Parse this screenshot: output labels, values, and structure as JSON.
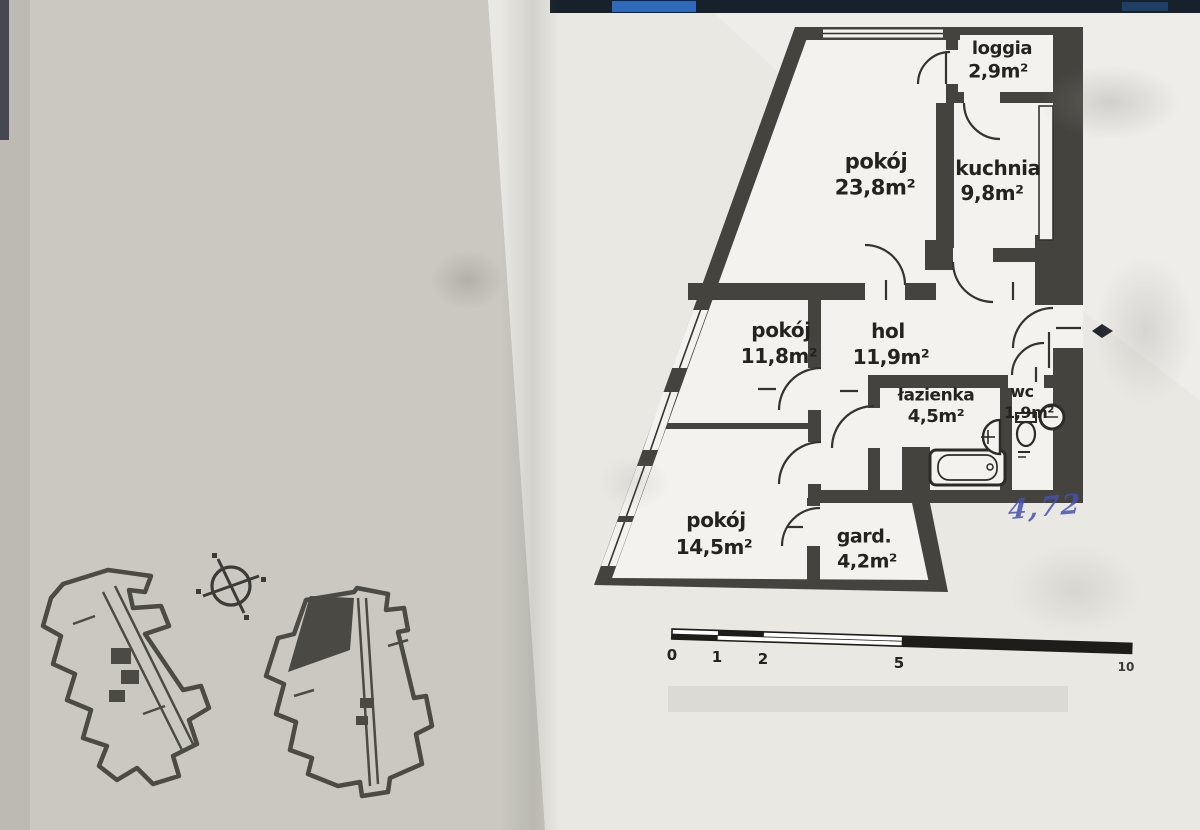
{
  "photo": {
    "handwritten_note": "4,72"
  },
  "floor_plan": {
    "rooms": [
      {
        "name": "loggia",
        "area": "2,9m²"
      },
      {
        "name": "pokój",
        "area": "23,8m²"
      },
      {
        "name": "kuchnia",
        "area": "9,8m²"
      },
      {
        "name": "pokój",
        "area": "11,8m²"
      },
      {
        "name": "hol",
        "area": "11,9m²"
      },
      {
        "name": "łazienka",
        "area": "4,5m²"
      },
      {
        "name": "wc",
        "area": "1,9m²"
      },
      {
        "name": "pokój",
        "area": "14,5m²"
      },
      {
        "name": "gard.",
        "area": "4,2m²"
      }
    ],
    "scale_bar": {
      "labels": [
        "0",
        "1",
        "2",
        "5",
        "10"
      ]
    }
  },
  "colors": {
    "wall": "#45433e",
    "paper_left": "#cbc8c2",
    "paper_right": "#e9e8e3",
    "plan_paper": "#f3f2ee",
    "top_band": "#16212c",
    "band_blue": "#2e6ab9",
    "handwriting_blue": "#4452b2"
  }
}
